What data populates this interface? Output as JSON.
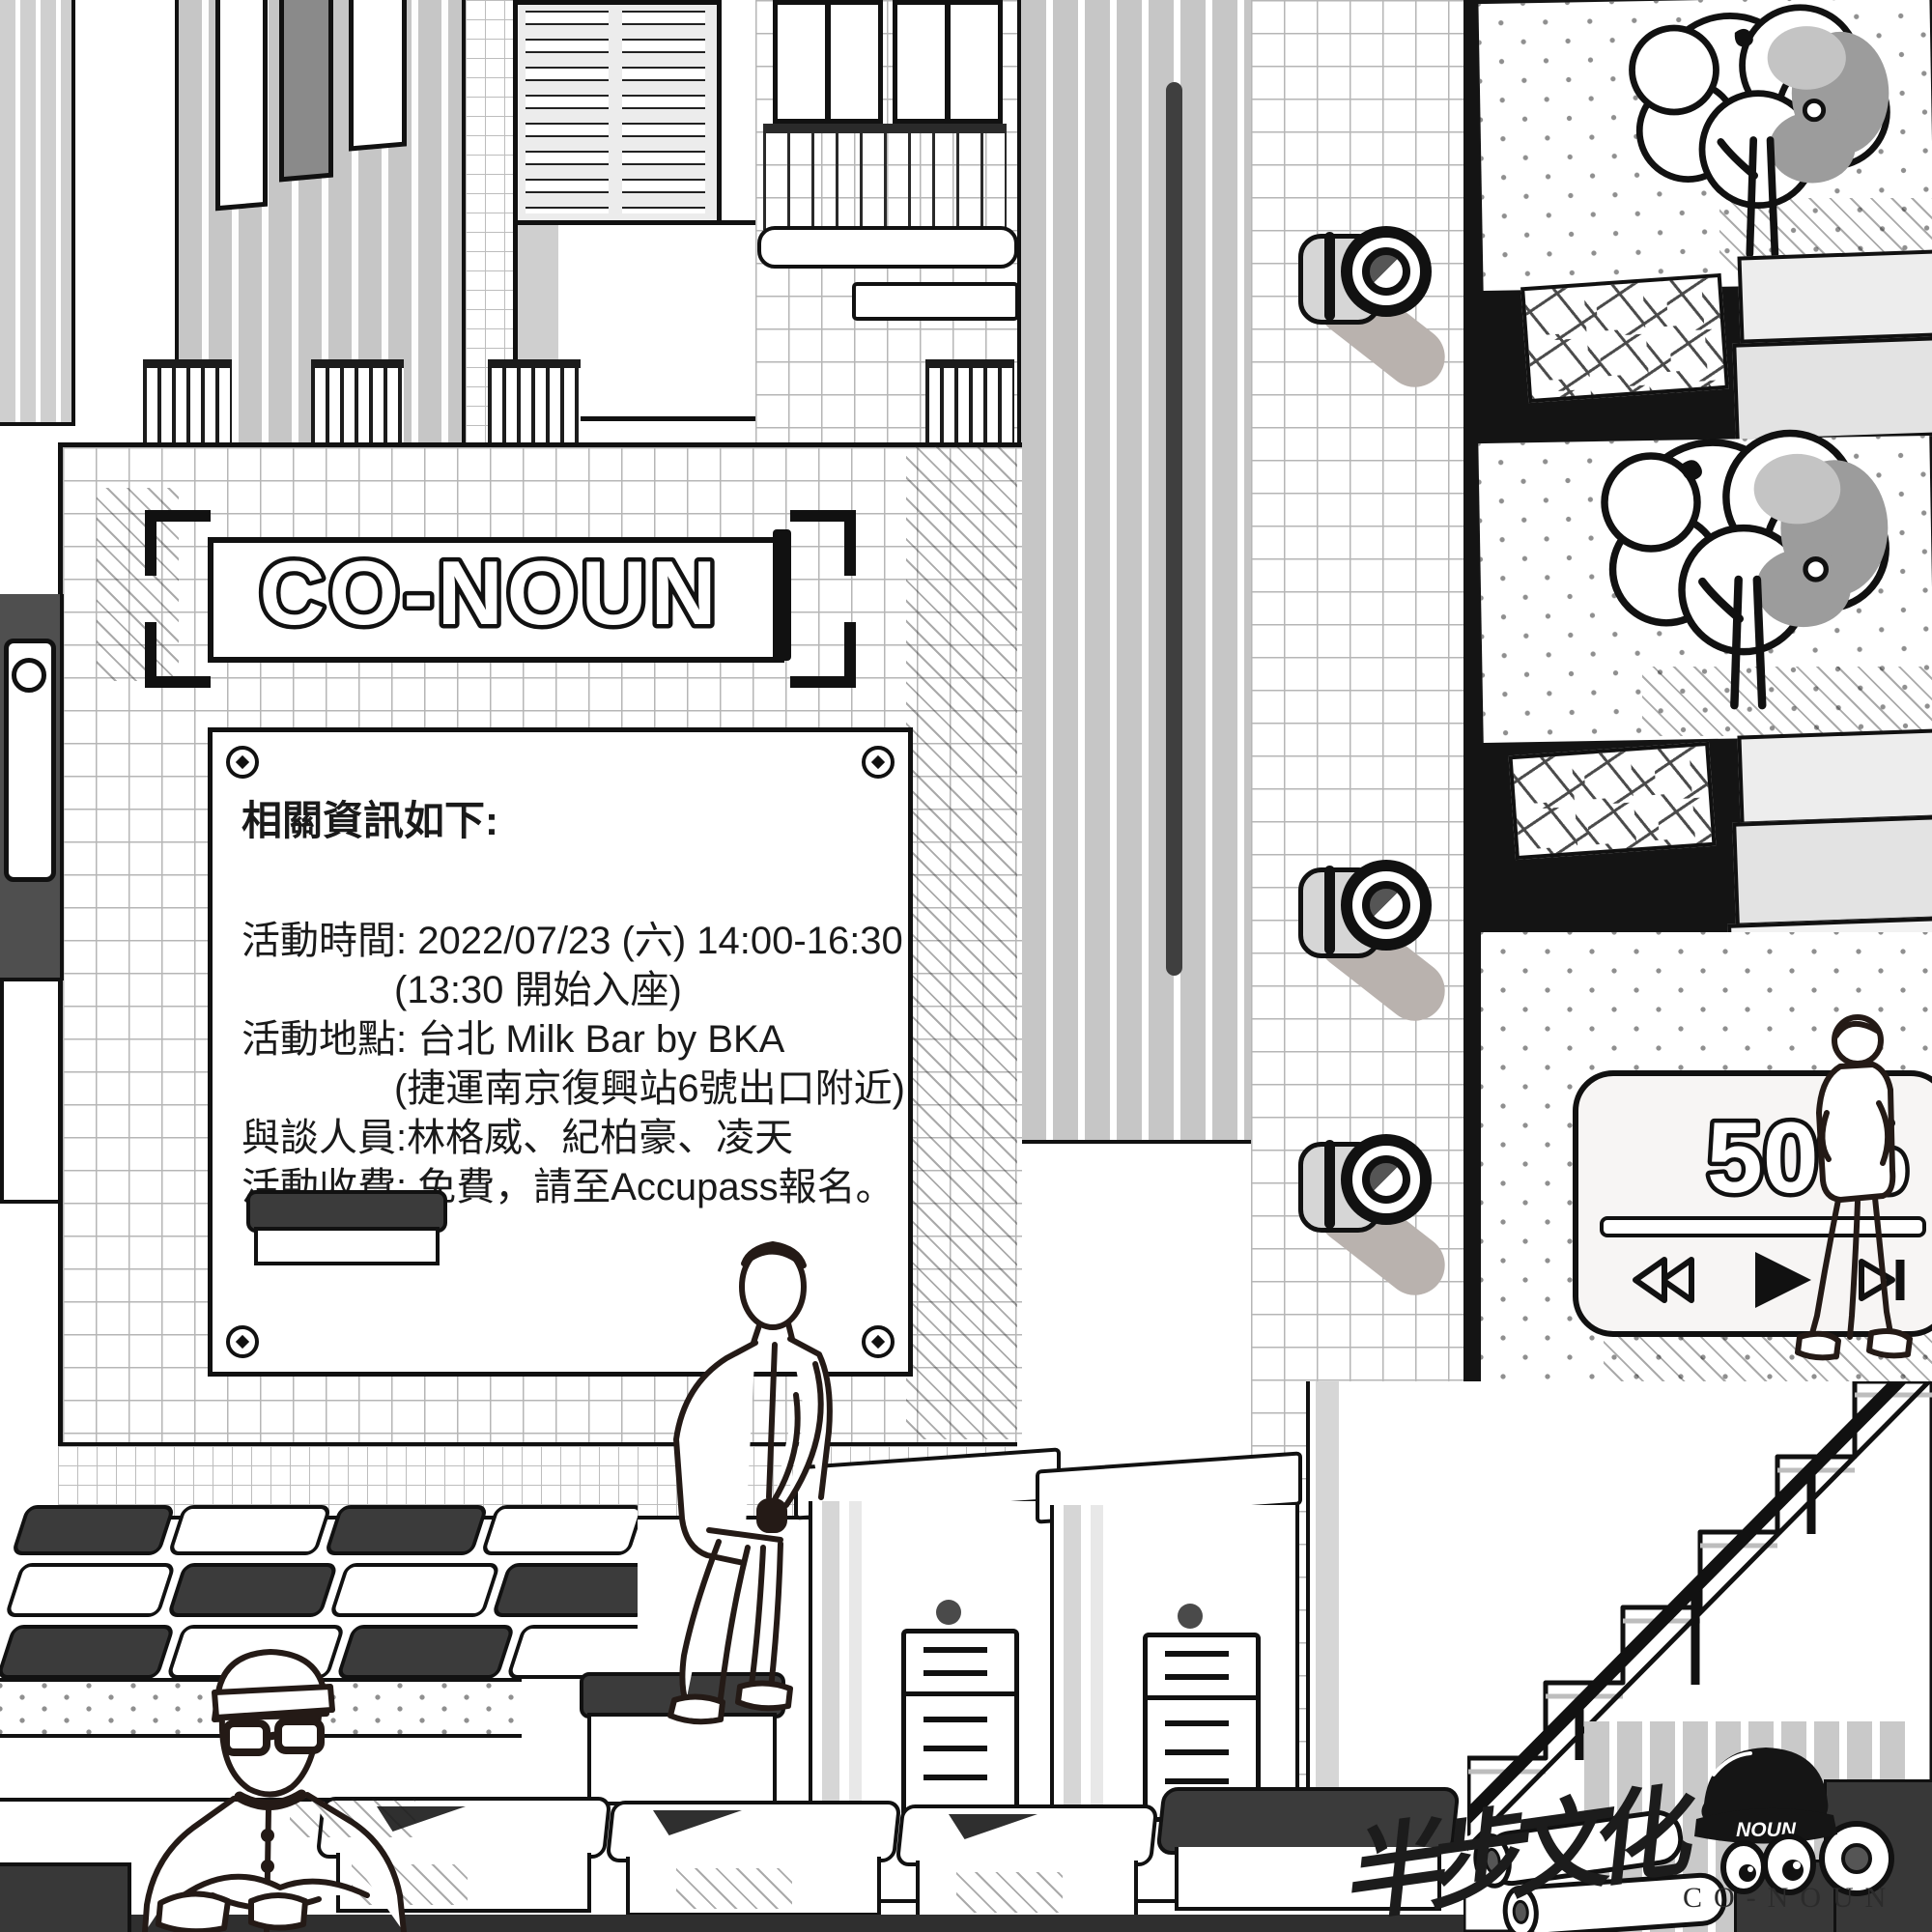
{
  "sign": {
    "title": "CO-NOUN"
  },
  "info_panel": {
    "heading": "相關資訊如下:",
    "lines": [
      "活動時間: 2022/07/23 (六) 14:00-16:30",
      "(13:30 開始入座)",
      "活動地點: 台北 Milk Bar by BKA",
      "(捷運南京復興站6號出口附近)",
      "與談人員:林格威、紀柏豪、凌天",
      "活動收費: 免費，請至Accupass報名。"
    ]
  },
  "player": {
    "progress_label": "50%",
    "icons": [
      "rewind-icon",
      "play-icon",
      "forward-icon"
    ]
  },
  "mascot": {
    "cap_text": "NOUN",
    "brand_text": "CO-NOUN"
  },
  "signature": "半步文化",
  "colors": {
    "ink": "#111111",
    "dark_gray": "#3b3b3b",
    "mid_gray": "#c6c6c6",
    "light_gray": "#ededed",
    "paper": "#ffffff"
  }
}
